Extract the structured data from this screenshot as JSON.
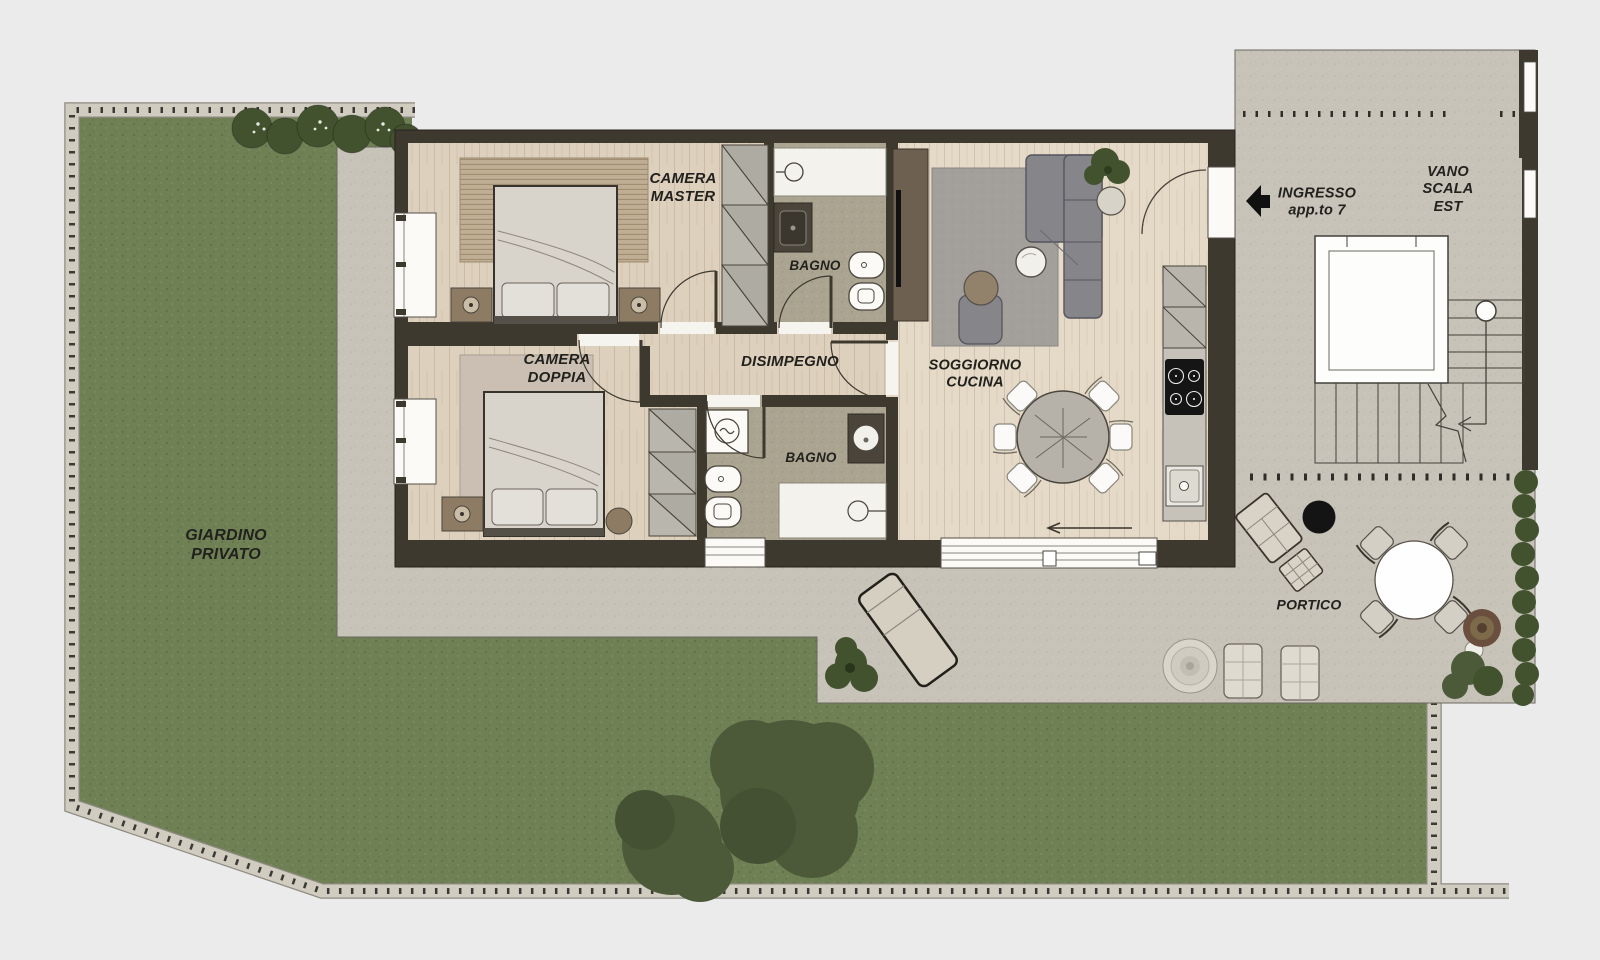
{
  "title": "Apartment 7 floor plan",
  "labels": {
    "giardino": [
      "GIARDINO",
      "PRIVATO"
    ],
    "camera_master": [
      "CAMERA",
      "MASTER"
    ],
    "bagno_1": [
      "BAGNO"
    ],
    "camera_doppia": [
      "CAMERA",
      "DOPPIA"
    ],
    "disimpegno": [
      "DISIMPEGNO"
    ],
    "bagno_2": [
      "BAGNO"
    ],
    "soggiorno": [
      "SOGGIORNO",
      "CUCINA"
    ],
    "ingresso": [
      "INGRESSO",
      "app.to 7"
    ],
    "vano_scala": [
      "VANO",
      "SCALA",
      "EST"
    ],
    "portico": [
      "PORTICO"
    ]
  },
  "colors": {
    "background": "#ebebec",
    "grass": "#6e8054",
    "path": "#d0ccc0",
    "path-edge": "#8d8a80",
    "paving": "#c7c3b8",
    "wall": "#3e392f",
    "wood-floor": "#ddd0bd",
    "wood-living": "#e5d9c7",
    "bath-floor": "#aba491",
    "label-ink": "#22211e",
    "line": "#4a453c",
    "sofa-gray": "#85858a",
    "hedge-green": "#42522f",
    "tree-green": "#4c5a3a",
    "rug-beige": "#bfae93",
    "accent-black": "#141414"
  }
}
